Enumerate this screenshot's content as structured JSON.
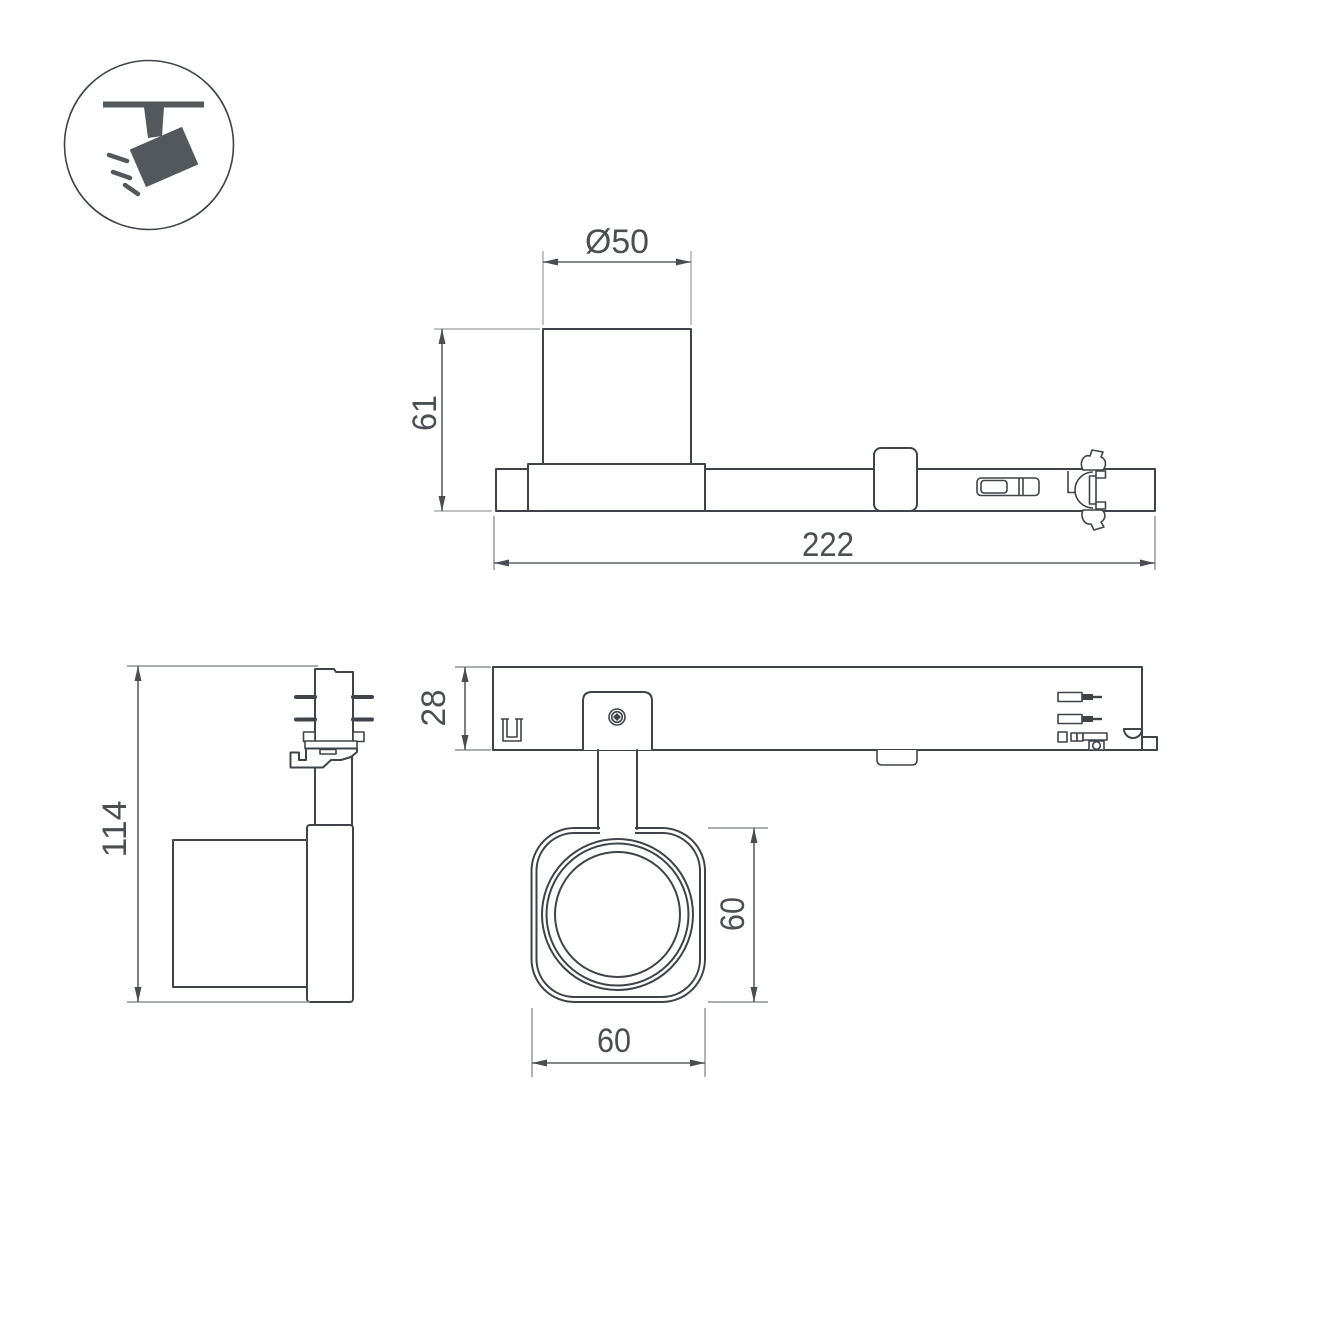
{
  "pictogram": {
    "name": "ceiling-track-spotlight"
  },
  "dimensions": {
    "lamp_diameter": "Ø50",
    "lamp_height": "61",
    "adapter_length": "222",
    "overall_height": "114",
    "adapter_depth": "28",
    "head_height": "60",
    "head_width": "60"
  },
  "colors": {
    "background": "#ffffff",
    "object_line": "#3f444a",
    "dimension_line": "#5c6165",
    "extension_line": "#8f9397",
    "extension_line_light": "#b7babc",
    "text": "#4b4f54",
    "icon_fill": "#53585d"
  }
}
